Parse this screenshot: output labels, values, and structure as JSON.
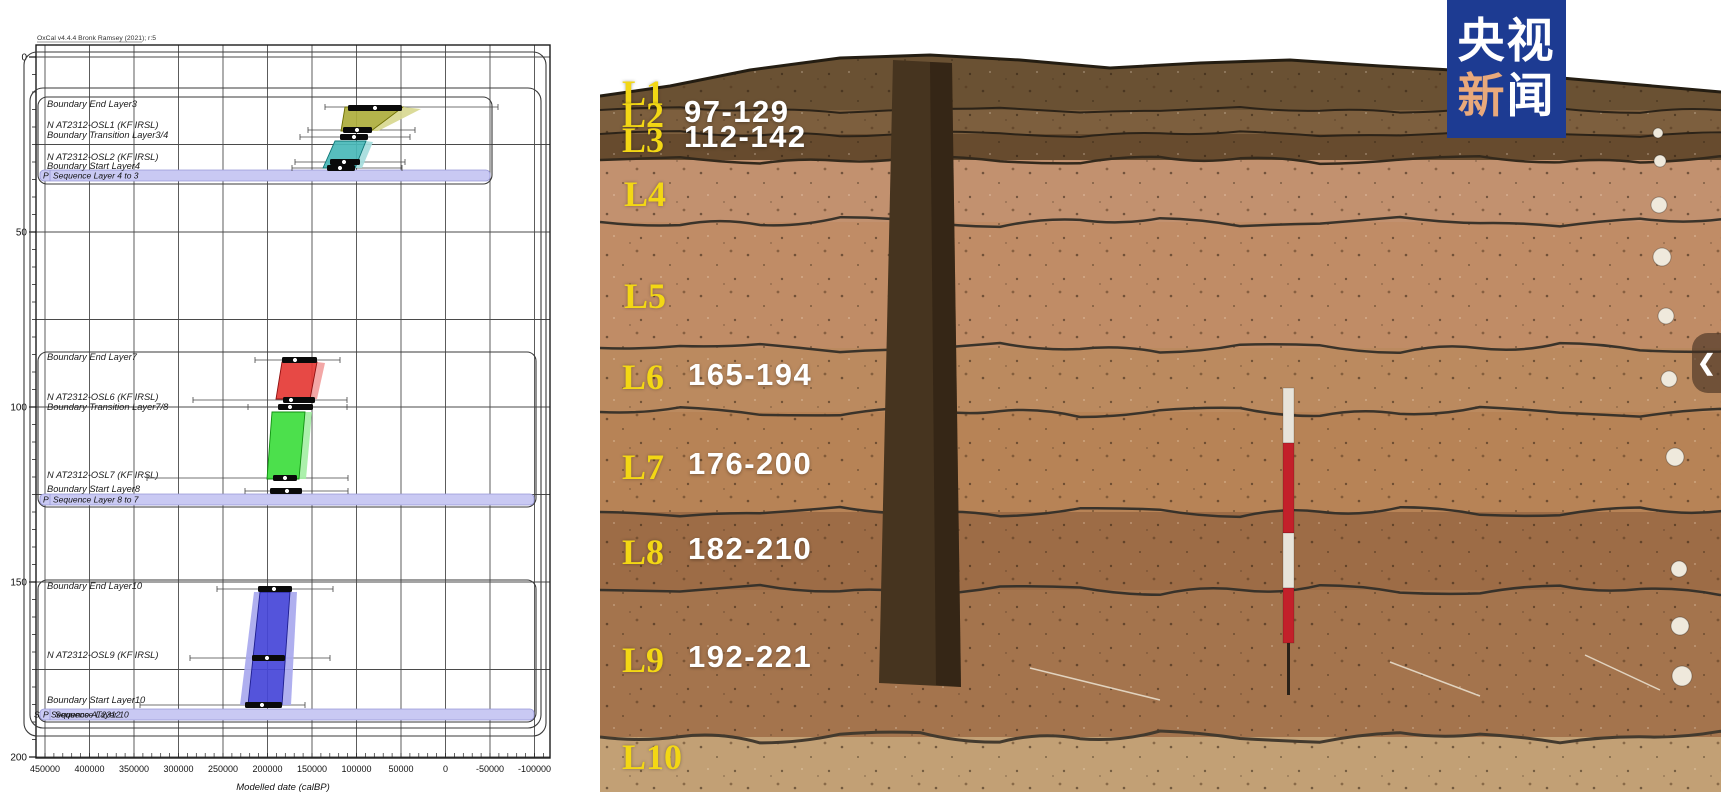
{
  "page": {
    "width": 1721,
    "height": 800,
    "background": "#ffffff"
  },
  "badge": {
    "line1": "央视",
    "line2_char1": "新",
    "line2_char2": "闻",
    "bg": "#1d3b92",
    "accent": "#e9a97b",
    "text_color": "#ffffff"
  },
  "photo": {
    "chevron_glyph": "❮",
    "label_color": "#f3d714",
    "value_color": "#ffffff",
    "layers": [
      {
        "label": "L1",
        "x": 22,
        "y": 93
      },
      {
        "label": "L2",
        "x": 22,
        "y": 115,
        "value": "97-129",
        "vx": 84,
        "vy": 112
      },
      {
        "label": "L3",
        "x": 22,
        "y": 140,
        "value": "112-142",
        "vx": 84,
        "vy": 137
      },
      {
        "label": "L4",
        "x": 24,
        "y": 194
      },
      {
        "label": "L5",
        "x": 24,
        "y": 296
      },
      {
        "label": "L6",
        "x": 22,
        "y": 377,
        "value": "165-194",
        "vx": 88,
        "vy": 375
      },
      {
        "label": "L7",
        "x": 22,
        "y": 467,
        "value": "176-200",
        "vx": 88,
        "vy": 464
      },
      {
        "label": "L8",
        "x": 22,
        "y": 552,
        "value": "182-210",
        "vx": 88,
        "vy": 549
      },
      {
        "label": "L9",
        "x": 22,
        "y": 660,
        "value": "192-221",
        "vx": 88,
        "vy": 657
      },
      {
        "label": "L10",
        "x": 22,
        "y": 757
      }
    ],
    "strata": [
      {
        "y": 40,
        "h": 70,
        "c": "#6a5133"
      },
      {
        "y": 110,
        "h": 24,
        "c": "#7d5f3e"
      },
      {
        "y": 134,
        "h": 26,
        "c": "#674b2e"
      },
      {
        "y": 160,
        "h": 62,
        "c": "#c2916f"
      },
      {
        "y": 222,
        "h": 126,
        "c": "#c08c66"
      },
      {
        "y": 348,
        "h": 64,
        "c": "#bb8a5f"
      },
      {
        "y": 412,
        "h": 100,
        "c": "#b78356"
      },
      {
        "y": 512,
        "h": 78,
        "c": "#9d6c46"
      },
      {
        "y": 590,
        "h": 147,
        "c": "#a4744d"
      },
      {
        "y": 737,
        "h": 55,
        "c": "#c2a075"
      }
    ],
    "boundaries": [
      {
        "y": 110,
        "c": "#2c2318",
        "w": 2,
        "a": 3
      },
      {
        "y": 134,
        "c": "#2c2318",
        "w": 2,
        "a": 3
      },
      {
        "y": 160,
        "c": "#33291c",
        "w": 2.5,
        "a": 4
      },
      {
        "y": 222,
        "c": "#3a332a",
        "w": 2.5,
        "a": 5
      },
      {
        "y": 348,
        "c": "#3a332a",
        "w": 2.5,
        "a": 5
      },
      {
        "y": 412,
        "c": "#3a332a",
        "w": 2.5,
        "a": 5
      },
      {
        "y": 512,
        "c": "#38322a",
        "w": 2.5,
        "a": 5
      },
      {
        "y": 590,
        "c": "#38322a",
        "w": 2.5,
        "a": 5
      },
      {
        "y": 737,
        "c": "#433a2e",
        "w": 3,
        "a": 6
      }
    ],
    "sky_points": [
      [
        0,
        96
      ],
      [
        70,
        86
      ],
      [
        150,
        70
      ],
      [
        240,
        58
      ],
      [
        330,
        55
      ],
      [
        420,
        60
      ],
      [
        510,
        68
      ],
      [
        600,
        63
      ],
      [
        690,
        60
      ],
      [
        780,
        66
      ],
      [
        870,
        71
      ],
      [
        950,
        77
      ],
      [
        1030,
        84
      ],
      [
        1121,
        92
      ]
    ],
    "trench": [
      [
        293,
        60
      ],
      [
        352,
        63
      ],
      [
        361,
        687
      ],
      [
        279,
        683
      ]
    ],
    "trench_shade": [
      [
        330,
        62
      ],
      [
        352,
        63
      ],
      [
        361,
        687
      ],
      [
        336,
        685
      ]
    ],
    "pole": {
      "x": 683,
      "w": 11,
      "segments": [
        [
          388,
          55,
          "#e8e4da"
        ],
        [
          443,
          90,
          "#c3202a"
        ],
        [
          533,
          55,
          "#e8e4da"
        ],
        [
          588,
          55,
          "#c3202a"
        ]
      ],
      "stick": [
        687,
        643,
        3,
        52,
        "#2a2118"
      ]
    },
    "dots": [
      [
        1058,
        133,
        5
      ],
      [
        1060,
        161,
        6
      ],
      [
        1059,
        205,
        8
      ],
      [
        1062,
        257,
        9
      ],
      [
        1066,
        316,
        8
      ],
      [
        1069,
        379,
        8
      ],
      [
        1075,
        457,
        9
      ],
      [
        1079,
        569,
        8
      ],
      [
        1080,
        626,
        9
      ],
      [
        1082,
        676,
        10
      ]
    ],
    "strings": [
      [
        430,
        668,
        560,
        700
      ],
      [
        790,
        662,
        880,
        696
      ],
      [
        985,
        655,
        1060,
        690
      ]
    ]
  },
  "chart_data": {
    "type": "oxcal_bayesian_depth_model",
    "title": "",
    "watermark": "OxCal v4.4.4 Bronk Ramsey (2021); r:5",
    "xlabel": "Modelled date (calBP)",
    "x_range": [
      450000,
      -100000
    ],
    "y_depth_range": [
      0,
      200
    ],
    "axis": {
      "frame": {
        "x1": 36,
        "y1": 45,
        "x2": 550,
        "y2": 758
      },
      "x_ticks": [
        {
          "label": "450000",
          "x": 45
        },
        {
          "label": "400000",
          "x": 89.5
        },
        {
          "label": "350000",
          "x": 134
        },
        {
          "label": "300000",
          "x": 178.5
        },
        {
          "label": "250000",
          "x": 223
        },
        {
          "label": "200000",
          "x": 267.5
        },
        {
          "label": "150000",
          "x": 312
        },
        {
          "label": "100000",
          "x": 356.5
        },
        {
          "label": "50000",
          "x": 401
        },
        {
          "label": "0",
          "x": 445.5
        },
        {
          "label": "-50000",
          "x": 490
        },
        {
          "label": "-100000",
          "x": 534.5
        }
      ],
      "y_ticks": [
        {
          "label": "0",
          "y": 57
        },
        {
          "label": "50",
          "y": 232
        },
        {
          "label": "100",
          "y": 407
        },
        {
          "label": "150",
          "y": 582
        },
        {
          "label": "200",
          "y": 757
        }
      ],
      "grid_y_step": 87.5,
      "grid_y_start": 57,
      "grid_y_end": 757,
      "minor_x_step": 8.9,
      "minor_y_step": 17.5
    },
    "outer_boxes": [
      [
        24,
        52,
        522,
        684
      ],
      [
        30,
        88,
        511,
        640
      ]
    ],
    "groups": [
      {
        "box": [
          38,
          97,
          454,
          87
        ],
        "band": [
          40,
          170,
          450,
          11
        ],
        "prefixes": [
          {
            "t": "P",
            "dx": 3
          }
        ],
        "band_labels": [
          {
            "t": "Sequence Layer 4 to 3",
            "dx": 13
          }
        ]
      },
      {
        "box": [
          38,
          352,
          498,
          155
        ],
        "band": [
          40,
          494,
          494,
          11
        ],
        "prefixes": [
          {
            "t": "P",
            "dx": 3
          }
        ],
        "band_labels": [
          {
            "t": "Sequence Layer 8 to 7",
            "dx": 13
          }
        ]
      },
      {
        "box": [
          38,
          580,
          498,
          142
        ],
        "band": [
          40,
          709,
          494,
          11
        ],
        "prefixes": [
          {
            "t": "S",
            "dx": -6
          },
          {
            "t": "P",
            "dx": 3
          }
        ],
        "band_labels": [
          {
            "t": "Sequence AT2312",
            "dx": 11
          },
          {
            "t": "Sequence Layer 10",
            "dx": 15
          }
        ]
      }
    ],
    "labels": [
      {
        "x": 47,
        "y": 104,
        "t": "Boundary End Layer3"
      },
      {
        "x": 47,
        "y": 125,
        "t": "N AT2312-OSL1 (KF IRSL)"
      },
      {
        "x": 47,
        "y": 135,
        "t": "Boundary Transition Layer3/4"
      },
      {
        "x": 47,
        "y": 157,
        "t": "N AT2312-OSL2 (KF IRSL)"
      },
      {
        "x": 47,
        "y": 166,
        "t": "Boundary Start Layer4"
      },
      {
        "x": 47,
        "y": 357,
        "t": "Boundary End Layer7"
      },
      {
        "x": 47,
        "y": 397,
        "t": "N AT2312-OSL6 (KF IRSL)"
      },
      {
        "x": 47,
        "y": 407,
        "t": "Boundary Transition Layer7/8"
      },
      {
        "x": 47,
        "y": 475,
        "t": "N AT2312-OSL7 (KF IRSL)"
      },
      {
        "x": 47,
        "y": 489,
        "t": "Boundary Start Layer8"
      },
      {
        "x": 47,
        "y": 586,
        "t": "Boundary End Layer10"
      },
      {
        "x": 47,
        "y": 655,
        "t": "N AT2312-OSL9 (KF IRSL)"
      },
      {
        "x": 47,
        "y": 700,
        "t": "Boundary Start Layer10"
      }
    ],
    "distributions": [
      {
        "name": "boundary-end-layer3-olive",
        "fill": "#aeae3c",
        "pale": "#d8d890",
        "stroke": "#6e6e00",
        "polys": [
          {
            "f": "pale",
            "pts": [
              [
                403,
                107
              ],
              [
                421,
                109
              ],
              [
                378,
                131
              ],
              [
                371,
                131
              ]
            ]
          },
          {
            "f": "fill",
            "pts": [
              [
                345,
                107
              ],
              [
                403,
                107
              ],
              [
                371,
                131
              ],
              [
                341,
                131
              ]
            ]
          }
        ],
        "bars": [
          [
            348,
            402,
            108,
            375
          ],
          [
            343,
            372,
            130,
            357
          ]
        ],
        "whiskers": [
          [
            325,
            498,
            107
          ],
          [
            308,
            415,
            130
          ]
        ]
      },
      {
        "name": "transition-3-4",
        "fill": "#aeae3c",
        "pale": "#d8d890",
        "stroke": "#6e6e00",
        "polys": [],
        "bars": [
          [
            340,
            368,
            137,
            354
          ]
        ],
        "whiskers": [
          [
            300,
            410,
            137
          ]
        ]
      },
      {
        "name": "osl2-teal",
        "fill": "#49b8b8",
        "pale": "#a5dcdc",
        "stroke": "#0c7474",
        "polys": [
          {
            "f": "pale",
            "pts": [
              [
                366,
                141
              ],
              [
                373,
                142
              ],
              [
                362,
                168
              ],
              [
                355,
                168
              ]
            ]
          },
          {
            "f": "fill",
            "pts": [
              [
                335,
                141
              ],
              [
                366,
                141
              ],
              [
                355,
                168
              ],
              [
                323,
                168
              ]
            ]
          }
        ],
        "bars": [
          [
            330,
            360,
            162,
            344
          ],
          [
            327,
            355,
            168,
            340
          ]
        ],
        "whiskers": [
          [
            295,
            405,
            162
          ],
          [
            292,
            402,
            168
          ]
        ]
      },
      {
        "name": "end-layer7-red",
        "fill": "#e53935",
        "pale": "#f2a09e",
        "stroke": "#8f0f0f",
        "polys": [
          {
            "f": "pale",
            "pts": [
              [
                317,
                362
              ],
              [
                325,
                363
              ],
              [
                317,
                399
              ],
              [
                310,
                399
              ]
            ]
          },
          {
            "f": "fill",
            "pts": [
              [
                282,
                362
              ],
              [
                317,
                362
              ],
              [
                310,
                399
              ],
              [
                276,
                399
              ]
            ]
          }
        ],
        "bars": [
          [
            282,
            317,
            360,
            295
          ],
          [
            283,
            315,
            400,
            291
          ],
          [
            278,
            313,
            407,
            290
          ]
        ],
        "whiskers": [
          [
            255,
            340,
            360
          ],
          [
            193,
            347,
            400
          ],
          [
            248,
            347,
            407
          ]
        ]
      },
      {
        "name": "osl7-green",
        "fill": "#3ddd3d",
        "pale": "#a5efa5",
        "stroke": "#0f8f0f",
        "polys": [
          {
            "f": "pale",
            "pts": [
              [
                305,
                412
              ],
              [
                312,
                412
              ],
              [
                306,
                479
              ],
              [
                299,
                479
              ]
            ]
          },
          {
            "f": "fill",
            "pts": [
              [
                272,
                412
              ],
              [
                305,
                412
              ],
              [
                299,
                479
              ],
              [
                267,
                479
              ]
            ]
          }
        ],
        "bars": [
          [
            273,
            297,
            478,
            285
          ],
          [
            270,
            302,
            491,
            287
          ]
        ],
        "whiskers": [
          [
            147,
            348,
            478
          ],
          [
            245,
            348,
            491
          ]
        ]
      },
      {
        "name": "layer10-blue",
        "fill": "#4545d8",
        "pale": "#a8a8ee",
        "stroke": "#1d1d8f",
        "polys": [
          {
            "f": "pale",
            "pts": [
              [
                254,
                592
              ],
              [
                260,
                592
              ],
              [
                248,
                705
              ],
              [
                240,
                705
              ]
            ]
          },
          {
            "f": "pale",
            "pts": [
              [
                290,
                592
              ],
              [
                297,
                592
              ],
              [
                291,
                705
              ],
              [
                282,
                705
              ]
            ]
          },
          {
            "f": "fill",
            "pts": [
              [
                260,
                592
              ],
              [
                290,
                592
              ],
              [
                282,
                705
              ],
              [
                248,
                705
              ]
            ]
          }
        ],
        "bars": [
          [
            258,
            292,
            589,
            274
          ],
          [
            252,
            285,
            658,
            267
          ],
          [
            245,
            282,
            705,
            262
          ]
        ],
        "whiskers": [
          [
            217,
            333,
            589
          ],
          [
            190,
            330,
            658
          ],
          [
            140,
            305,
            705
          ]
        ]
      }
    ]
  }
}
